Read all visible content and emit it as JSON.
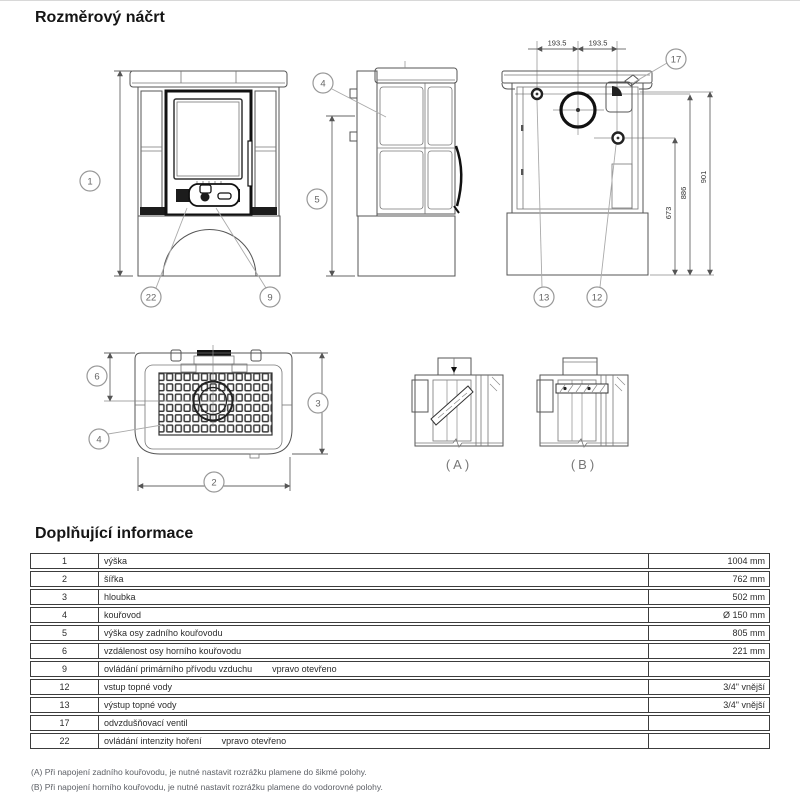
{
  "page": {
    "title": "Rozměrový náčrt"
  },
  "drawing": {
    "callouts": {
      "c1": "1",
      "c22": "22",
      "c9": "9",
      "c4_side": "4",
      "c5": "5",
      "c17": "17",
      "c13": "13",
      "c12": "12",
      "c6": "6",
      "c3": "3",
      "c4_top": "4",
      "c2": "2"
    },
    "dims": {
      "top_left": "193.5",
      "top_right": "193.5",
      "h673": "673",
      "h886": "886",
      "h901": "901"
    },
    "views": {
      "a": "(A)",
      "b": "(B)"
    }
  },
  "info": {
    "title": "Doplňující informace",
    "rows": [
      {
        "num": "1",
        "label": "výška",
        "value": "1004 mm"
      },
      {
        "num": "2",
        "label": "šířka",
        "value": "762 mm"
      },
      {
        "num": "3",
        "label": "hloubka",
        "value": "502 mm"
      },
      {
        "num": "4",
        "label": "kouřovod",
        "value": "Ø 150 mm"
      },
      {
        "num": "5",
        "label": "výška osy zadního kouřovodu",
        "value": "805 mm"
      },
      {
        "num": "6",
        "label": "vzdálenost osy horního kouřovodu",
        "value": "221 mm"
      },
      {
        "num": "9",
        "label": "ovládání primárního přívodu vzduchu",
        "note": "vpravo otevřeno",
        "value": ""
      },
      {
        "num": "12",
        "label": "vstup topné vody",
        "value": "3/4\" vnější"
      },
      {
        "num": "13",
        "label": "výstup topné vody",
        "value": "3/4\" vnější"
      },
      {
        "num": "17",
        "label": "odvzdušňovací ventil",
        "value": ""
      },
      {
        "num": "22",
        "label": "ovládání intenzity hoření",
        "note": "vpravo otevřeno",
        "value": ""
      }
    ],
    "footnotes": [
      "(A) Při napojení zadního kouřovodu, je nutné nastavit rozrážku plamene do šikmé polohy.",
      "(B) Při napojení horního kouřovodu, je nutné nastavit rozrážku plamene do vodorovné polohy."
    ]
  }
}
